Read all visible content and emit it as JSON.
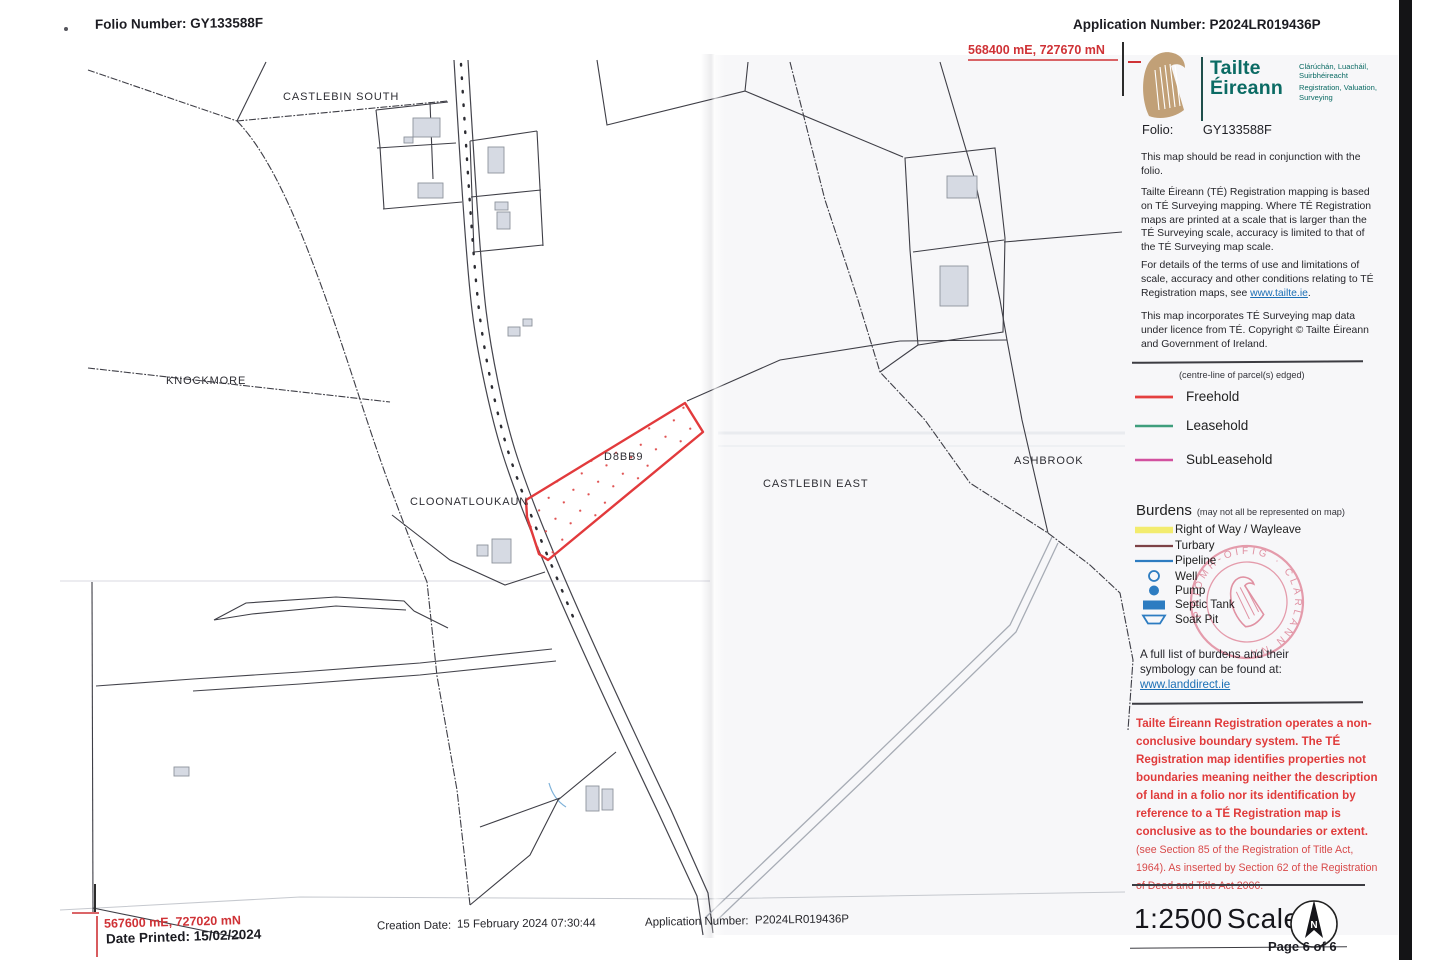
{
  "header": {
    "folio_number": "Folio Number: GY133588F",
    "application_number": "Application Number: P2024LR019436P"
  },
  "coordinates": {
    "top_right": "568400 mE, 727670 mN",
    "bottom_left": "567600 mE, 727020 mN"
  },
  "map": {
    "townlands": {
      "castlebin_south": "CASTLEBIN SOUTH",
      "knockmore": "KNOCKMORE",
      "cloonatloukaun": "CLOONATLOUKAUN",
      "castlebin_east": "CASTLEBIN EAST",
      "ashbrook": "ASHBROOK"
    },
    "parcel_id": "D8BB9",
    "parcel_edge_color": "#e23a3c"
  },
  "sidebar": {
    "brand": {
      "name_line1": "Tailte",
      "name_line2": "Éireann",
      "tagline_irish_1": "Clárúchán, Luacháil,",
      "tagline_irish_2": "Suirbhéireacht",
      "tagline_en_1": "Registration, Valuation,",
      "tagline_en_2": "Surveying",
      "accent_color": "#0b6b64"
    },
    "folio_label": "Folio:",
    "folio_value": "GY133588F",
    "para_conjunction": "This map should be read in conjunction with the folio.",
    "para_registration": "Tailte Éireann (TÉ) Registration mapping is based on TÉ Surveying mapping. Where TÉ Registration maps are printed at a scale that is larger than the TÉ Surveying scale, accuracy is limited to that of the TÉ Surveying map scale.",
    "para_terms_pre": "For details of the terms of use and limitations of scale, accuracy and other conditions relating to TÉ Registration maps, see ",
    "tailte_link": "www.tailte.ie",
    "para_terms_post": ".",
    "para_copyright": "This map incorporates TÉ Surveying map data under licence from TÉ. Copyright © Tailte Éireann and Government of Ireland.",
    "centre_line_note": "(centre-line of parcel(s) edged)",
    "ownership_legend": [
      {
        "label": "Freehold",
        "color": "#e4403f"
      },
      {
        "label": "Leasehold",
        "color": "#3f9e7c"
      },
      {
        "label": "SubLeasehold",
        "color": "#d2519f"
      }
    ],
    "burdens_title": "Burdens",
    "burdens_note": "(may not all be represented on map)",
    "burdens_legend": [
      {
        "label": "Right of Way / Wayleave",
        "symbol": "thick-yellow-line",
        "color": "#f3eb5f"
      },
      {
        "label": "Turbary",
        "symbol": "maroon-line",
        "color": "#7d4246"
      },
      {
        "label": "Pipeline",
        "symbol": "blue-line",
        "color": "#2d7cc1"
      },
      {
        "label": "Well",
        "symbol": "circle-outline",
        "color": "#2d7cc1"
      },
      {
        "label": "Pump",
        "symbol": "filled-circle",
        "color": "#2d7cc1"
      },
      {
        "label": "Septic Tank",
        "symbol": "filled-rect",
        "color": "#2d7cc1"
      },
      {
        "label": "Soak Pit",
        "symbol": "trapezoid-outline",
        "color": "#2d7cc1"
      }
    ],
    "burdens_more_1": "A full list of burdens and their",
    "burdens_more_2": "symbology can be found at:",
    "landdirect_link": "www.landdirect.ie",
    "warning_bold": "Tailte Éireann Registration operates a non-conclusive boundary system. The TÉ Registration map identifies properties not boundaries meaning neither the description of land in a folio nor its identification by reference to a TÉ Registration map is conclusive as to the boundaries or extent.",
    "warning_regular": " (see Section 85 of the Registration of Title Act, 1964). As inserted by Section 62 of the Registration of Deed and Title Act 2006.",
    "stamp_text": "PRÍOMH-OIFIG · CLÁRLANN NA ·",
    "scale_ratio": "1:2500",
    "scale_word": "Scale",
    "north_label": "N",
    "page_label": "Page 6 of 6"
  },
  "footer": {
    "date_printed": "Date Printed: 15/02/2024",
    "creation_label": "Creation Date:",
    "creation_value": "15 February 2024 07:30:44",
    "application_label": "Application Number:",
    "application_value": "P2024LR019436P"
  }
}
